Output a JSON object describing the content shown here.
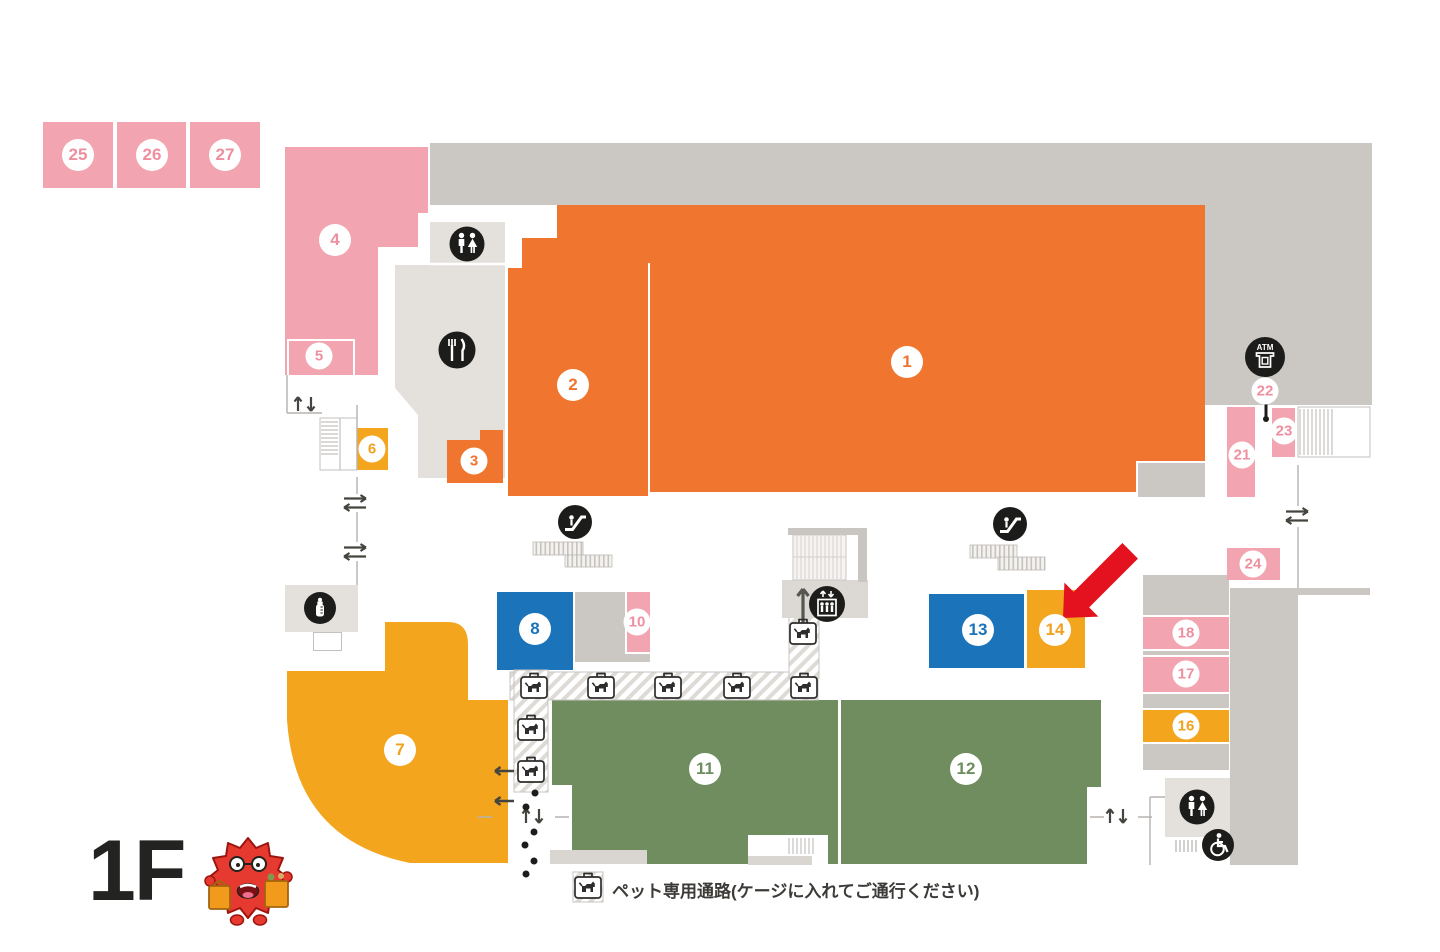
{
  "floor_label": "1F",
  "legend": {
    "pet_path": "ペット専用通路(ケージに入れてご通行ください)"
  },
  "atm": {
    "label": "ATM"
  },
  "highlight": {
    "arrow_points_to_area": "14",
    "arrow_color": "#e4111f"
  },
  "areas": {
    "n1": "1",
    "n2": "2",
    "n3": "3",
    "n4": "4",
    "n5": "5",
    "n6": "6",
    "n7": "7",
    "n8": "8",
    "n10": "10",
    "n11": "11",
    "n12": "12",
    "n13": "13",
    "n14": "14",
    "n16": "16",
    "n17": "17",
    "n18": "18",
    "n21": "21",
    "n22": "22",
    "n23": "23",
    "n24": "24",
    "n25": "25",
    "n26": "26",
    "n27": "27"
  },
  "colors": {
    "orange_area": "#f0752f",
    "pink_area": "#f2a5b0",
    "yellow_area": "#f4a51e",
    "blue_area": "#1b73b9",
    "green_area": "#6f8d5e",
    "gray_backs": "#cbc8c4",
    "light_gray_backs": "#e4e1dd",
    "icon_black": "#1c1c1a",
    "highlight_red": "#e4111f"
  },
  "icons": [
    "restroom-icon",
    "restaurant-icon",
    "escalator-icon",
    "elevator-icon",
    "atm-icon",
    "nursing-room-icon",
    "wheelchair-icon",
    "pet-carrier-icon",
    "stairs",
    "up-down-arrows",
    "two-way-arrows",
    "mascot-character"
  ]
}
